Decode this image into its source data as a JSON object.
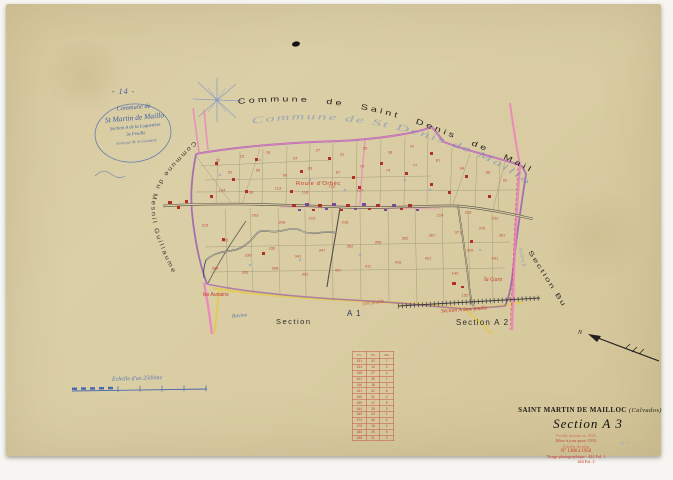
{
  "scan": {
    "paper_color": "#d9cca4",
    "ink_blue": "#3f5fa5",
    "ink_red": "#c0392b",
    "ink_black": "#2e2c28",
    "boundary_purple": "#9a5fb0",
    "road_pink": "#ec7fc0",
    "road_yellow": "#e0cb55",
    "pencil_blue": "#8fa8d0"
  },
  "header": {
    "page_number": "- 14 -",
    "cartouche": {
      "line1": "Commune de",
      "line2": "St Martin de Maillo",
      "line3": "Section A de la Loquetière",
      "line4": "3e Feuille",
      "line5": "levée par M. le Géomètre"
    }
  },
  "neighbors": {
    "top_print": "Commune de Saint Denis de Mailloc",
    "top_script": "Commune de St Denis de Mailloc",
    "left": "Commune du Mesnil Guillaume",
    "right": "Section Bu",
    "right_script": "Section B"
  },
  "map": {
    "route_label": "Route d'Orbéc",
    "gare_label": "la Gare",
    "hamlet_label": "les Aunains",
    "ravine_label": "Ravine",
    "section_word": "Section",
    "section_a1": "A 1",
    "section_a1_script": "1ère feuille",
    "section_a2": "Section A 2",
    "section_a2_script": "Section A 2me feuille",
    "parcel_numbers": [
      {
        "x": 218,
        "y": 160,
        "t": "12"
      },
      {
        "x": 242,
        "y": 156,
        "t": "15"
      },
      {
        "x": 268,
        "y": 152,
        "t": "18"
      },
      {
        "x": 295,
        "y": 158,
        "t": "24"
      },
      {
        "x": 318,
        "y": 150,
        "t": "27"
      },
      {
        "x": 342,
        "y": 154,
        "t": "31"
      },
      {
        "x": 365,
        "y": 148,
        "t": "35"
      },
      {
        "x": 390,
        "y": 152,
        "t": "38"
      },
      {
        "x": 412,
        "y": 146,
        "t": "41"
      },
      {
        "x": 230,
        "y": 172,
        "t": "52"
      },
      {
        "x": 258,
        "y": 170,
        "t": "56"
      },
      {
        "x": 285,
        "y": 175,
        "t": "60"
      },
      {
        "x": 310,
        "y": 168,
        "t": "63"
      },
      {
        "x": 338,
        "y": 172,
        "t": "67"
      },
      {
        "x": 362,
        "y": 166,
        "t": "70"
      },
      {
        "x": 388,
        "y": 170,
        "t": "74"
      },
      {
        "x": 415,
        "y": 165,
        "t": "77"
      },
      {
        "x": 438,
        "y": 160,
        "t": "81"
      },
      {
        "x": 462,
        "y": 168,
        "t": "84"
      },
      {
        "x": 488,
        "y": 172,
        "t": "88"
      },
      {
        "x": 505,
        "y": 180,
        "t": "92"
      },
      {
        "x": 222,
        "y": 190,
        "t": "104"
      },
      {
        "x": 250,
        "y": 192,
        "t": "108"
      },
      {
        "x": 278,
        "y": 188,
        "t": "113"
      },
      {
        "x": 305,
        "y": 192,
        "t": "118"
      },
      {
        "x": 332,
        "y": 186,
        "t": "122"
      },
      {
        "x": 360,
        "y": 190,
        "t": "127"
      },
      {
        "x": 255,
        "y": 215,
        "t": "203"
      },
      {
        "x": 282,
        "y": 222,
        "t": "208"
      },
      {
        "x": 312,
        "y": 218,
        "t": "213"
      },
      {
        "x": 345,
        "y": 222,
        "t": "218"
      },
      {
        "x": 440,
        "y": 215,
        "t": "224"
      },
      {
        "x": 468,
        "y": 212,
        "t": "228"
      },
      {
        "x": 495,
        "y": 218,
        "t": "232"
      },
      {
        "x": 205,
        "y": 225,
        "t": "315"
      },
      {
        "x": 225,
        "y": 240,
        "t": "322"
      },
      {
        "x": 248,
        "y": 255,
        "t": "330"
      },
      {
        "x": 272,
        "y": 248,
        "t": "336"
      },
      {
        "x": 298,
        "y": 256,
        "t": "341"
      },
      {
        "x": 322,
        "y": 250,
        "t": "347"
      },
      {
        "x": 350,
        "y": 246,
        "t": "352"
      },
      {
        "x": 378,
        "y": 242,
        "t": "358"
      },
      {
        "x": 405,
        "y": 238,
        "t": "362"
      },
      {
        "x": 432,
        "y": 235,
        "t": "367"
      },
      {
        "x": 458,
        "y": 232,
        "t": "371"
      },
      {
        "x": 482,
        "y": 228,
        "t": "376"
      },
      {
        "x": 502,
        "y": 235,
        "t": "381"
      },
      {
        "x": 215,
        "y": 268,
        "t": "388"
      },
      {
        "x": 245,
        "y": 272,
        "t": "393"
      },
      {
        "x": 275,
        "y": 268,
        "t": "398"
      },
      {
        "x": 305,
        "y": 274,
        "t": "402"
      },
      {
        "x": 338,
        "y": 270,
        "t": "407"
      },
      {
        "x": 368,
        "y": 266,
        "t": "411"
      },
      {
        "x": 398,
        "y": 262,
        "t": "416"
      },
      {
        "x": 428,
        "y": 258,
        "t": "421"
      },
      {
        "x": 470,
        "y": 250,
        "t": "426"
      },
      {
        "x": 495,
        "y": 258,
        "t": "431"
      },
      {
        "x": 455,
        "y": 273,
        "t": "149"
      },
      {
        "x": 465,
        "y": 295,
        "t": "152"
      }
    ]
  },
  "scale_bar": {
    "label": "Échelle d'un 2500me"
  },
  "table": {
    "headers": [
      "N°s",
      "N°s",
      "Obs"
    ],
    "rows": [
      [
        "131",
        "42",
        "7"
      ],
      [
        "134",
        "13",
        "2"
      ],
      [
        "138",
        "27",
        "4"
      ],
      [
        "141",
        "35",
        "1"
      ],
      [
        "146",
        "18",
        "3"
      ],
      [
        "151",
        "22",
        "6"
      ],
      [
        "155",
        "31",
        "2"
      ],
      [
        "159",
        "17",
        "5"
      ],
      [
        "164",
        "28",
        "3"
      ],
      [
        "169",
        "24",
        "1"
      ],
      [
        "174",
        "36",
        "4"
      ],
      [
        "179",
        "15",
        "2"
      ],
      [
        "184",
        "29",
        "5"
      ],
      [
        "188",
        "21",
        "3"
      ]
    ]
  },
  "title_block": {
    "commune": "SAINT MARTIN DE MAILLOC",
    "departement": "(Calvados)",
    "section": "Section A 3",
    "note1": "Feuille dressée en 1826",
    "note2": "Mise à jour pour 1933",
    "note3": "Échelle du plan",
    "note4": "N° 1388 à 1950",
    "note5": "Tirage photographique : 444 Fol. 1",
    "note6": "444 Fol. 2",
    "pencil": "A ="
  },
  "north_arrow": {
    "label": "N"
  }
}
